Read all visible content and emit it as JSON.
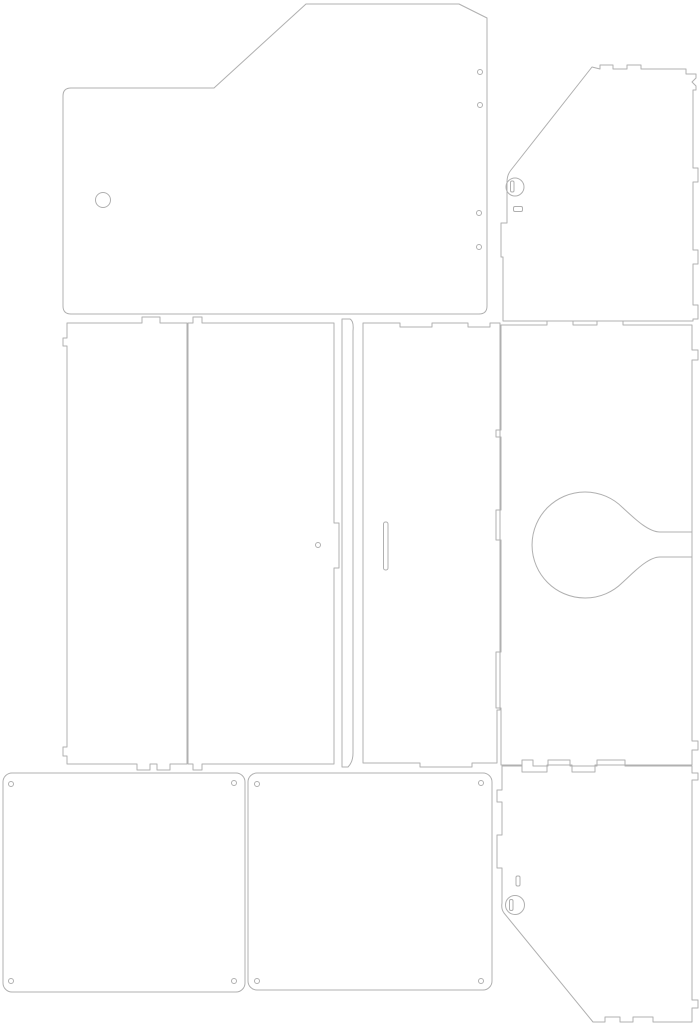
{
  "meta": {
    "description": "Laser-cut enclosure panel cutting template with eight outlined parts",
    "background": "#ffffff",
    "stroke_color": "#b0b0b0",
    "stroke_width": 1,
    "canvas": {
      "width": 699,
      "height": 1024
    }
  },
  "diagram": {
    "panels": [
      {
        "name": "top-left-panel",
        "shapes": [
          {
            "type": "path",
            "d": "M 63,96 Q 63,88 71,88 L 214,88 L 306,4 L 459,4 L 487,18 L 487,306 Q 487,314 479,314 L 71,314 Q 63,314 63,306 Z"
          },
          {
            "type": "circle",
            "cx": 103,
            "cy": 200,
            "r": 7.5
          },
          {
            "type": "circle",
            "cx": 480,
            "cy": 72,
            "r": 2.5
          },
          {
            "type": "circle",
            "cx": 480,
            "cy": 105,
            "r": 2.5
          },
          {
            "type": "circle",
            "cx": 479,
            "cy": 213,
            "r": 2.5
          },
          {
            "type": "circle",
            "cx": 479,
            "cy": 247,
            "r": 2.5
          }
        ]
      },
      {
        "name": "top-right-panel",
        "shapes": [
          {
            "type": "path",
            "d": "M 592,67 L 600,69 L 600,65 L 613,65 L 613,69 L 627,69 L 627,65 L 641,65 L 641,69 L 686,69 L 686,74 L 696,74 L 696,78 L 692,82 L 696,86 L 696,90 L 693,90 L 693,168 L 698,168 L 698,182 L 693,182 L 693,250 L 698,250 L 698,264 L 693,264 L 693,305 L 698,305 L 698,319 L 693,319 L 693,321 L 503,321 L 503,257 L 501,257 L 501,223 L 507,223 L 507,182 Q 507,175 511,170 Z"
          },
          {
            "type": "circle",
            "cx": 515,
            "cy": 187,
            "r": 9
          },
          {
            "type": "rect",
            "x": 510.5,
            "y": 181,
            "w": 3.5,
            "h": 11,
            "rx": 1.5
          },
          {
            "type": "rect",
            "x": 513.5,
            "y": 206.5,
            "w": 9,
            "h": 5,
            "rx": 1.5
          }
        ]
      },
      {
        "name": "middle-left-panel",
        "shapes": [
          {
            "type": "path",
            "d": "M 67,323 L 142,323 L 142,317 L 160,317 L 160,323 L 187,323 L 187,764 L 170,764 L 170,770 L 157,770 L 157,764 L 150,764 L 150,770 L 137,770 L 137,764 L 67,764 L 67,756 L 63,756 L 63,747 L 67,747 L 67,346 L 63,346 L 63,338 L 67,338 Z"
          }
        ]
      },
      {
        "name": "middle-center-left-panel",
        "shapes": [
          {
            "type": "path",
            "d": "M 188,323 L 193,323 L 193,317 L 202,317 L 202,323 L 334,323 L 334,523 L 339,523 L 339,568 L 334,568 L 334,764 L 202,764 L 202,770 L 193,770 L 193,764 L 188,764 Z"
          },
          {
            "type": "circle",
            "cx": 318,
            "cy": 545,
            "r": 2.5
          }
        ]
      },
      {
        "name": "divider-strip",
        "shapes": [
          {
            "type": "path",
            "d": "M 342,319 L 350,319 Q 354,321 353,331 L 353,753 Q 353,762 348,767 L 342,767 Z"
          }
        ]
      },
      {
        "name": "center-door-panel",
        "shapes": [
          {
            "type": "path",
            "d": "M 363,323 L 400,323 L 400,327 L 432,327 L 432,323 L 468,323 L 468,327 L 490,327 L 490,323 L 500,323 L 500,710 L 497,710 L 497,763 L 472,763 L 472,767 L 420,767 L 420,763 L 363,763 Z"
          },
          {
            "type": "rect",
            "x": 383.5,
            "y": 522,
            "w": 4.5,
            "h": 48,
            "rx": 2
          }
        ]
      },
      {
        "name": "middle-right-panel",
        "shapes": [
          {
            "type": "path",
            "d": "M 501,325 L 547,325 L 547,321 L 573,321 L 573,325 L 597,325 L 597,321 L 623,321 L 623,325 L 692,325 L 692,350 L 698,350 L 698,360 L 692,360 L 692,741 L 698,741 L 698,750 L 692,750 L 692,765 L 595,765 L 595,772 L 572,772 L 572,765 L 547,765 L 547,772 L 522,772 L 522,765 L 501,765 L 501,708 L 496,708 L 496,652 L 501,652 L 501,540 L 496,540 L 496,510 L 501,510 L 501,437 L 496,437 L 496,430 L 501,430 Z"
          },
          {
            "type": "path",
            "d": "M 692,532 L 660,532 C 648,532 634,518 622.5,507.5 A 53,53 0 1 0 622.5,582.5 C 634,572 648,557 660,557 L 692,557"
          }
        ]
      },
      {
        "name": "bottom-left-plate",
        "shapes": [
          {
            "type": "rect",
            "x": 3,
            "y": 773,
            "w": 242,
            "h": 219,
            "rx": 9
          },
          {
            "type": "circle",
            "cx": 11,
            "cy": 784,
            "r": 2.5
          },
          {
            "type": "circle",
            "cx": 234,
            "cy": 783,
            "r": 2.5
          },
          {
            "type": "circle",
            "cx": 11,
            "cy": 981,
            "r": 2.5
          },
          {
            "type": "circle",
            "cx": 234,
            "cy": 981,
            "r": 2.5
          }
        ]
      },
      {
        "name": "bottom-middle-plate",
        "shapes": [
          {
            "type": "rect",
            "x": 248,
            "y": 773,
            "w": 244,
            "h": 217,
            "rx": 9
          },
          {
            "type": "circle",
            "cx": 257,
            "cy": 784,
            "r": 2.5
          },
          {
            "type": "circle",
            "cx": 481,
            "cy": 783,
            "r": 2.5
          },
          {
            "type": "circle",
            "cx": 257,
            "cy": 981,
            "r": 2.5
          },
          {
            "type": "circle",
            "cx": 481,
            "cy": 981,
            "r": 2.5
          }
        ]
      },
      {
        "name": "bottom-right-panel",
        "shapes": [
          {
            "type": "path",
            "d": "M 502,766 L 522,766 L 522,760 L 533,760 L 533,766 L 548,766 L 548,760 L 570,760 L 570,766 L 597,766 L 597,760 L 625,760 L 625,766 L 692,766 L 692,773 L 698,773 L 698,780 L 692,780 L 692,1000 L 698,1000 L 698,1008 L 692,1008 L 692,1022 L 653,1022 L 653,1017 L 633,1017 L 633,1022 L 620,1022 L 620,1017 L 605,1017 L 605,1022 L 593,1022 L 504,913 Q 501,909 502,903 L 502,868 L 497,868 L 497,835 L 502,835 L 502,802 L 497,802 L 497,790 L 502,790 Z"
          },
          {
            "type": "rect",
            "x": 516,
            "y": 876,
            "w": 4,
            "h": 10,
            "rx": 1.5
          },
          {
            "type": "circle",
            "cx": 515,
            "cy": 905,
            "r": 9.5
          },
          {
            "type": "rect",
            "x": 509.5,
            "y": 899.5,
            "w": 3.5,
            "h": 11,
            "rx": 1.5
          }
        ]
      }
    ]
  }
}
